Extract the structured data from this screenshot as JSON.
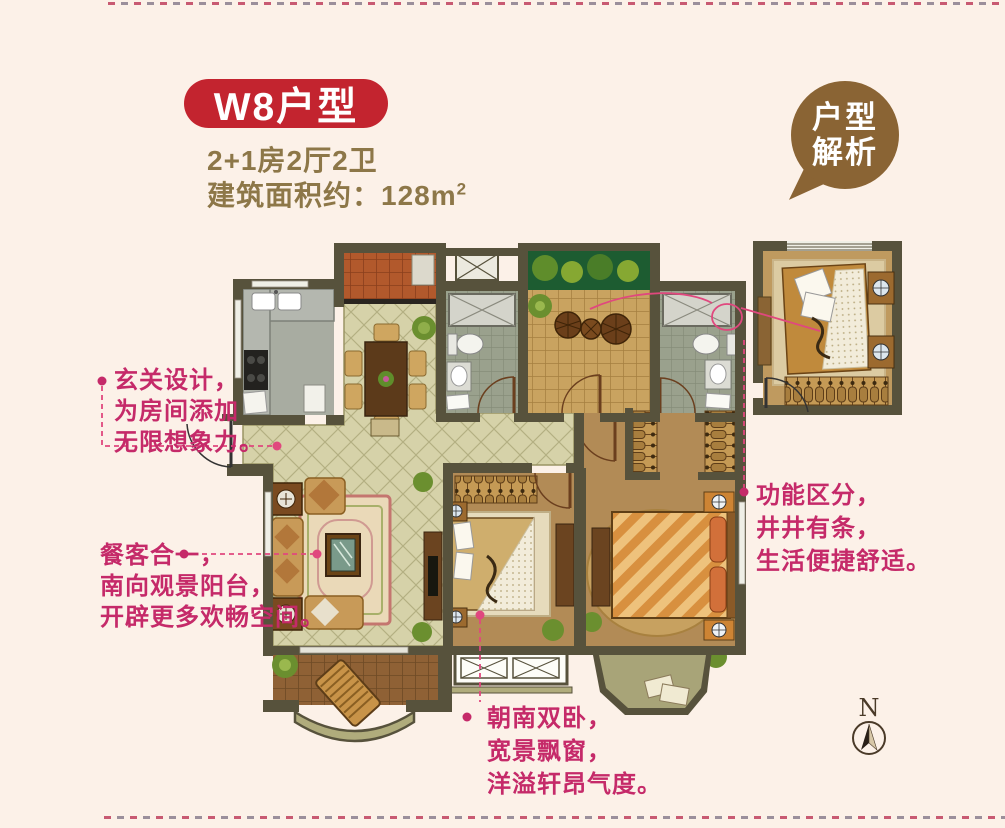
{
  "header": {
    "badge": "W8户型",
    "spec": "2+1房2厅2卫",
    "area": "建筑面积约：128m",
    "area_sup": "2"
  },
  "bubble": {
    "line1": "户型",
    "line2": "解析"
  },
  "annotations": {
    "entry": {
      "text": "玄关设计，\n为房间添加\n无限想象力。"
    },
    "dining": {
      "text": "餐客合一，\n南向观景阳台，\n开辟更多欢畅空间。"
    },
    "function": {
      "text": "功能区分，\n井井有条，\n生活便捷舒适。"
    },
    "bedroom": {
      "text": "朝南双卧，\n宽景飘窗，\n洋溢轩昂气度。"
    }
  },
  "compass": {
    "label": "N"
  },
  "colors": {
    "background": "#fcf1e8",
    "badge_red": "#c3242f",
    "gold_text": "#8d7748",
    "bubble_brown": "#8a6434",
    "annotation_pink": "#c52a69",
    "connector_pink": "#e0487e",
    "wall": "#57523c",
    "tile_beige": "#d6d2a9",
    "floor_tan": "#b28b56",
    "terrace_tan": "#c9a360",
    "porch_terracotta": "#b2592c",
    "balcony_brown": "#8f6135",
    "bath_tile": "#9aa18d",
    "plant_green": "#6b8f2f"
  }
}
